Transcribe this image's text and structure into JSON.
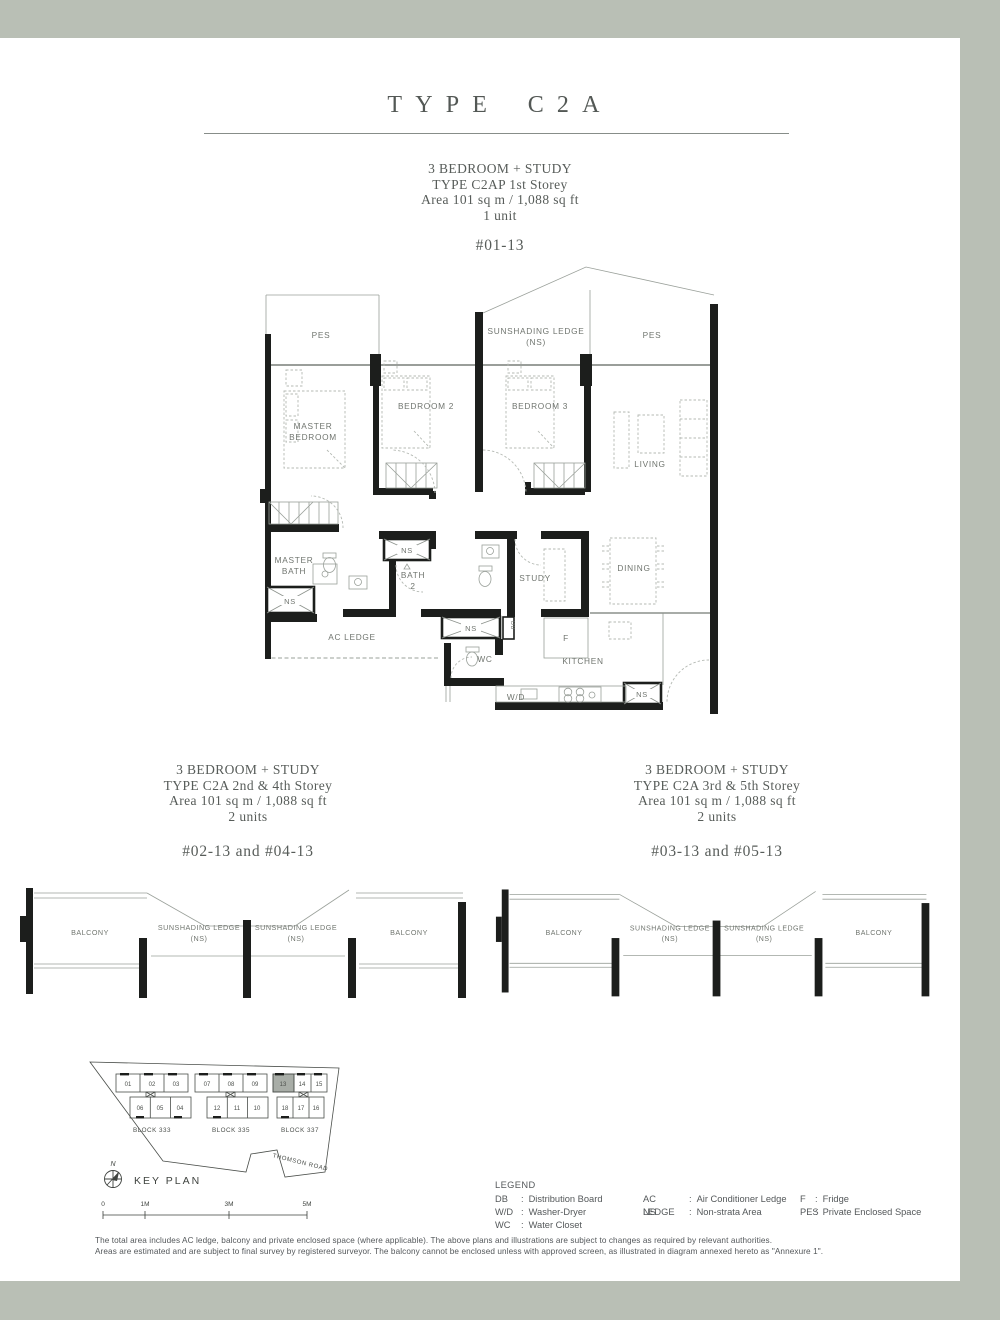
{
  "page": {
    "title": "TYPE C2A",
    "border_color": "#b9bfb5"
  },
  "sections": {
    "first": {
      "lines": [
        "3 BEDROOM + STUDY",
        "TYPE C2AP 1st Storey",
        "Area 101 sq m / 1,088 sq ft",
        "1 unit"
      ],
      "unit_no": "#01-13"
    },
    "second": {
      "lines": [
        "3 BEDROOM + STUDY",
        "TYPE C2A 2nd & 4th Storey",
        "Area 101 sq m / 1,088 sq ft",
        "2 units"
      ],
      "unit_no": "#02-13 and #04-13"
    },
    "third": {
      "lines": [
        "3 BEDROOM + STUDY",
        "TYPE C2A 3rd & 5th Storey",
        "Area 101 sq m / 1,088 sq ft",
        "2 units"
      ],
      "unit_no": "#03-13 and #05-13"
    }
  },
  "floorplan": {
    "labels": {
      "pes": "PES",
      "ledge": "SUNSHADING LEDGE",
      "ledge_ns": "(NS)",
      "master_l1": "MASTER",
      "master_l2": "BEDROOM",
      "bedroom2": "BEDROOM 2",
      "bedroom3": "BEDROOM 3",
      "living": "LIVING",
      "mbath_l1": "MASTER",
      "mbath_l2": "BATH",
      "bath2_l1": "BATH",
      "bath2_l2": "2",
      "study": "STUDY",
      "dining": "DINING",
      "ac_ledge": "AC LEDGE",
      "wc": "WC",
      "kitchen": "KITCHEN",
      "wd": "W/D",
      "fridge": "F",
      "db": "DB",
      "ns": "NS"
    }
  },
  "balcony": {
    "balcony": "BALCONY",
    "ledge": "SUNSHADING LEDGE",
    "ns": "(NS)"
  },
  "keyplan": {
    "title": "KEY PLAN",
    "north": "N",
    "road": "THOMSON ROAD",
    "highlighted_unit": "13",
    "blocks": [
      {
        "name": "BLOCK 333",
        "top": [
          "01",
          "02",
          "03"
        ],
        "bottom": [
          "06",
          "05",
          "04"
        ]
      },
      {
        "name": "BLOCK 335",
        "top": [
          "07",
          "08",
          "09"
        ],
        "bottom": [
          "12",
          "11",
          "10"
        ]
      },
      {
        "name": "BLOCK 337",
        "top": [
          "13",
          "14",
          "15"
        ],
        "bottom": [
          "18",
          "17",
          "16"
        ]
      }
    ],
    "scale": [
      "0",
      "1M",
      "3M",
      "5M"
    ]
  },
  "legend": {
    "title": "LEGEND",
    "separator": ":",
    "items": [
      {
        "abbr": "DB",
        "desc": "Distribution Board"
      },
      {
        "abbr": "W/D",
        "desc": "Washer-Dryer"
      },
      {
        "abbr": "WC",
        "desc": "Water Closet"
      },
      {
        "abbr": "AC LEDGE",
        "desc": "Air Conditioner Ledge"
      },
      {
        "abbr": "NS",
        "desc": "Non-strata Area"
      },
      {
        "abbr": "F",
        "desc": "Fridge"
      },
      {
        "abbr": "PES",
        "desc": "Private Enclosed Space"
      }
    ]
  },
  "footer": {
    "line1": "The total area includes AC ledge, balcony and private enclosed space (where applicable). The above plans and illustrations are subject to changes as required by relevant authorities.",
    "line2": "Areas are estimated and are subject to final survey by registered surveyor. The balcony cannot be enclosed unless with approved screen, as illustrated in diagram annexed hereto as \"Annexure 1\"."
  }
}
